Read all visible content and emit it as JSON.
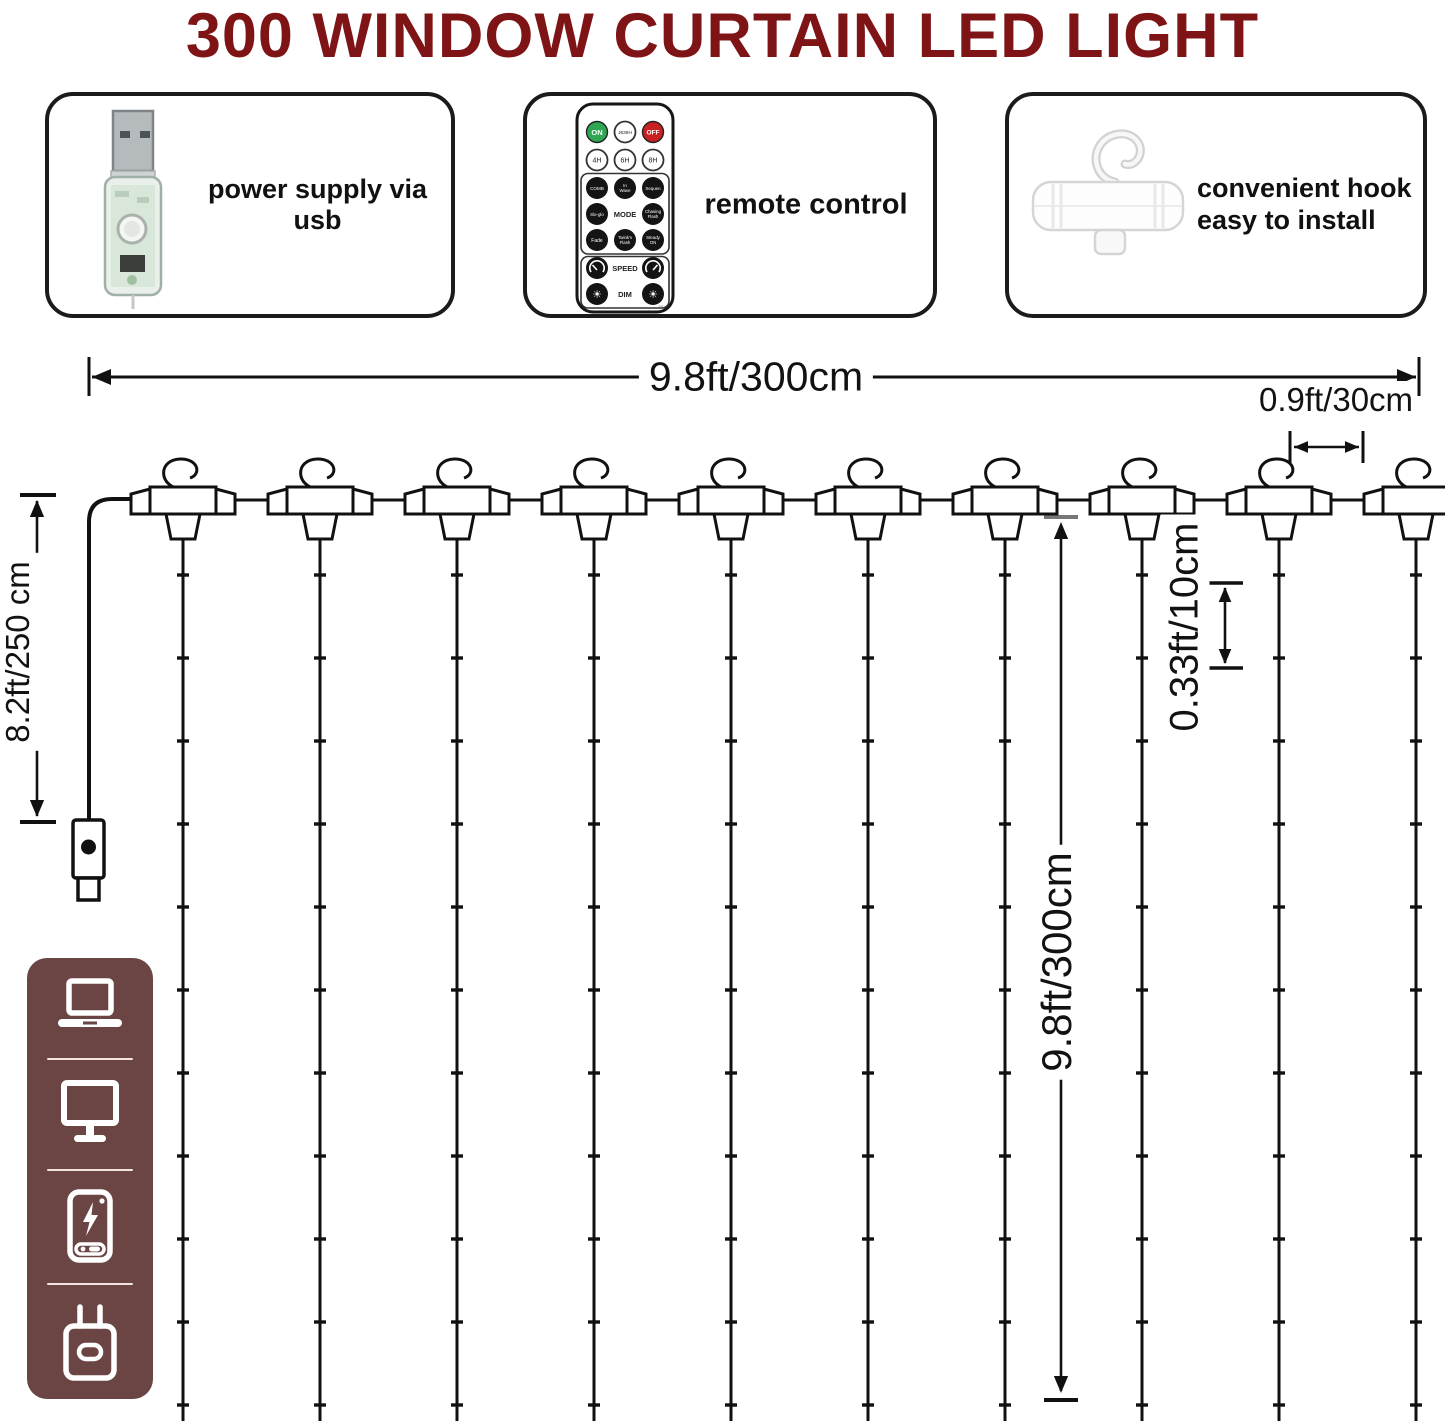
{
  "title": "300 WINDOW CURTAIN LED LIGHT",
  "colors": {
    "title": "#7e1416",
    "sidebar_panel": "#6a4544",
    "line": "#111111",
    "remote_on_green": "#2fa654",
    "remote_off_red": "#c92121"
  },
  "features": [
    {
      "name": "usb-power",
      "label": "power supply via usb"
    },
    {
      "name": "remote-control",
      "label": "remote control"
    },
    {
      "name": "hook",
      "label_line1": "convenient hook",
      "label_line2": "easy to install"
    }
  ],
  "remote": {
    "on": "ON",
    "timer": "J639H",
    "off": "OFF",
    "t4h": "4H",
    "t6h": "6H",
    "t8h": "8H",
    "comb": "COMB",
    "wave1": "In",
    "wave2": "Wave",
    "seq": "Sequen",
    "sloglo": "Slo-glo",
    "mode": "MODE",
    "chasing1": "Chasing",
    "chasing2": "Flash",
    "fade": "Fade",
    "twink1": "Twink's",
    "twink2": "Flash",
    "steady1": "Steady",
    "steady2": "ON",
    "speed": "SPEED",
    "dim": "DIM",
    "serial": "111"
  },
  "dimensions": {
    "total_width": "9.8ft/300cm",
    "hook_spacing": "0.9ft/30cm",
    "power_cord_length": "8.2ft/250 cm",
    "led_spacing": "0.33ft/10cm",
    "drop_height": "9.8ft/300cm"
  },
  "diagram": {
    "hook_count": 10,
    "leds_per_string": 11
  },
  "sidebar": {
    "icons": [
      "laptop",
      "monitor",
      "power-bank",
      "wall-plug"
    ]
  }
}
